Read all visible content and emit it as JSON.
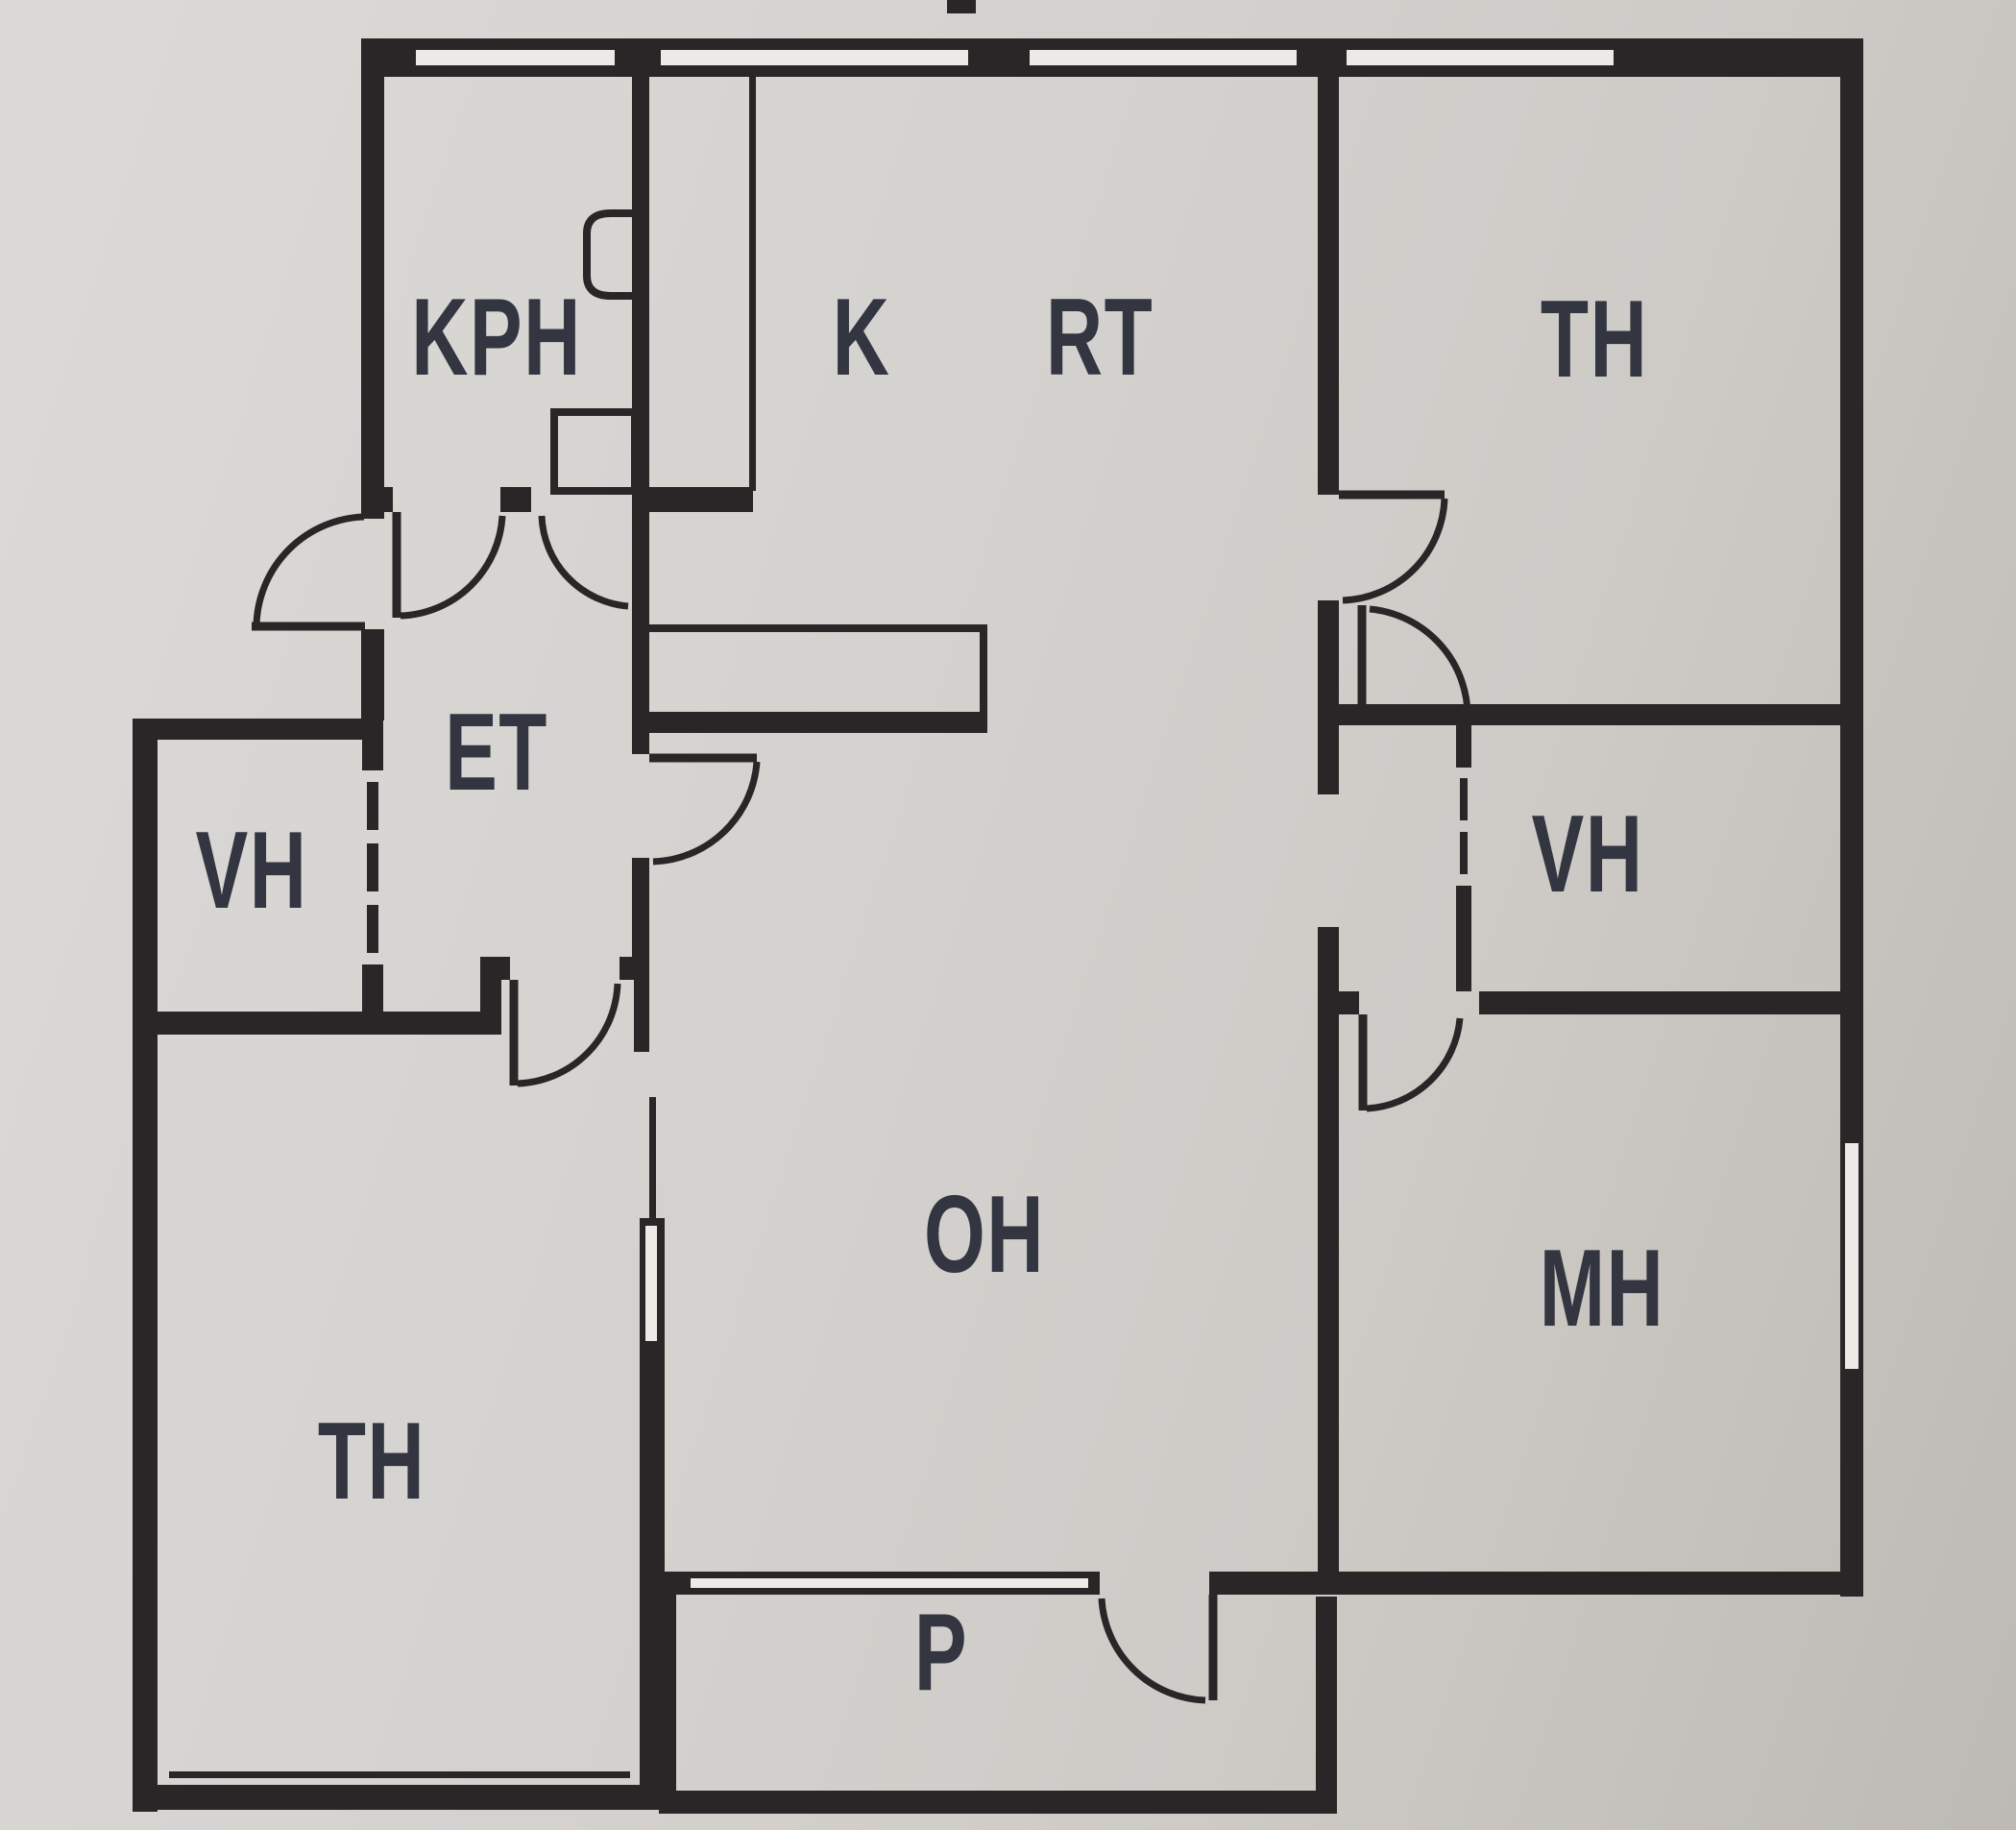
{
  "plan": {
    "type": "apartment-floor-plan",
    "language": "finnish-room-abbreviations"
  },
  "rooms": {
    "kph": {
      "label": "KPH"
    },
    "k": {
      "label": "K"
    },
    "rt": {
      "label": "RT"
    },
    "th_top": {
      "label": "TH"
    },
    "et": {
      "label": "ET"
    },
    "vh_left": {
      "label": "VH"
    },
    "vh_right": {
      "label": "VH"
    },
    "oh": {
      "label": "OH"
    },
    "mh": {
      "label": "MH"
    },
    "th_bottom": {
      "label": "TH"
    },
    "p": {
      "label": "P"
    }
  },
  "colors": {
    "wall": "#2a2527",
    "window": "#eceae6",
    "label": "#333541"
  }
}
